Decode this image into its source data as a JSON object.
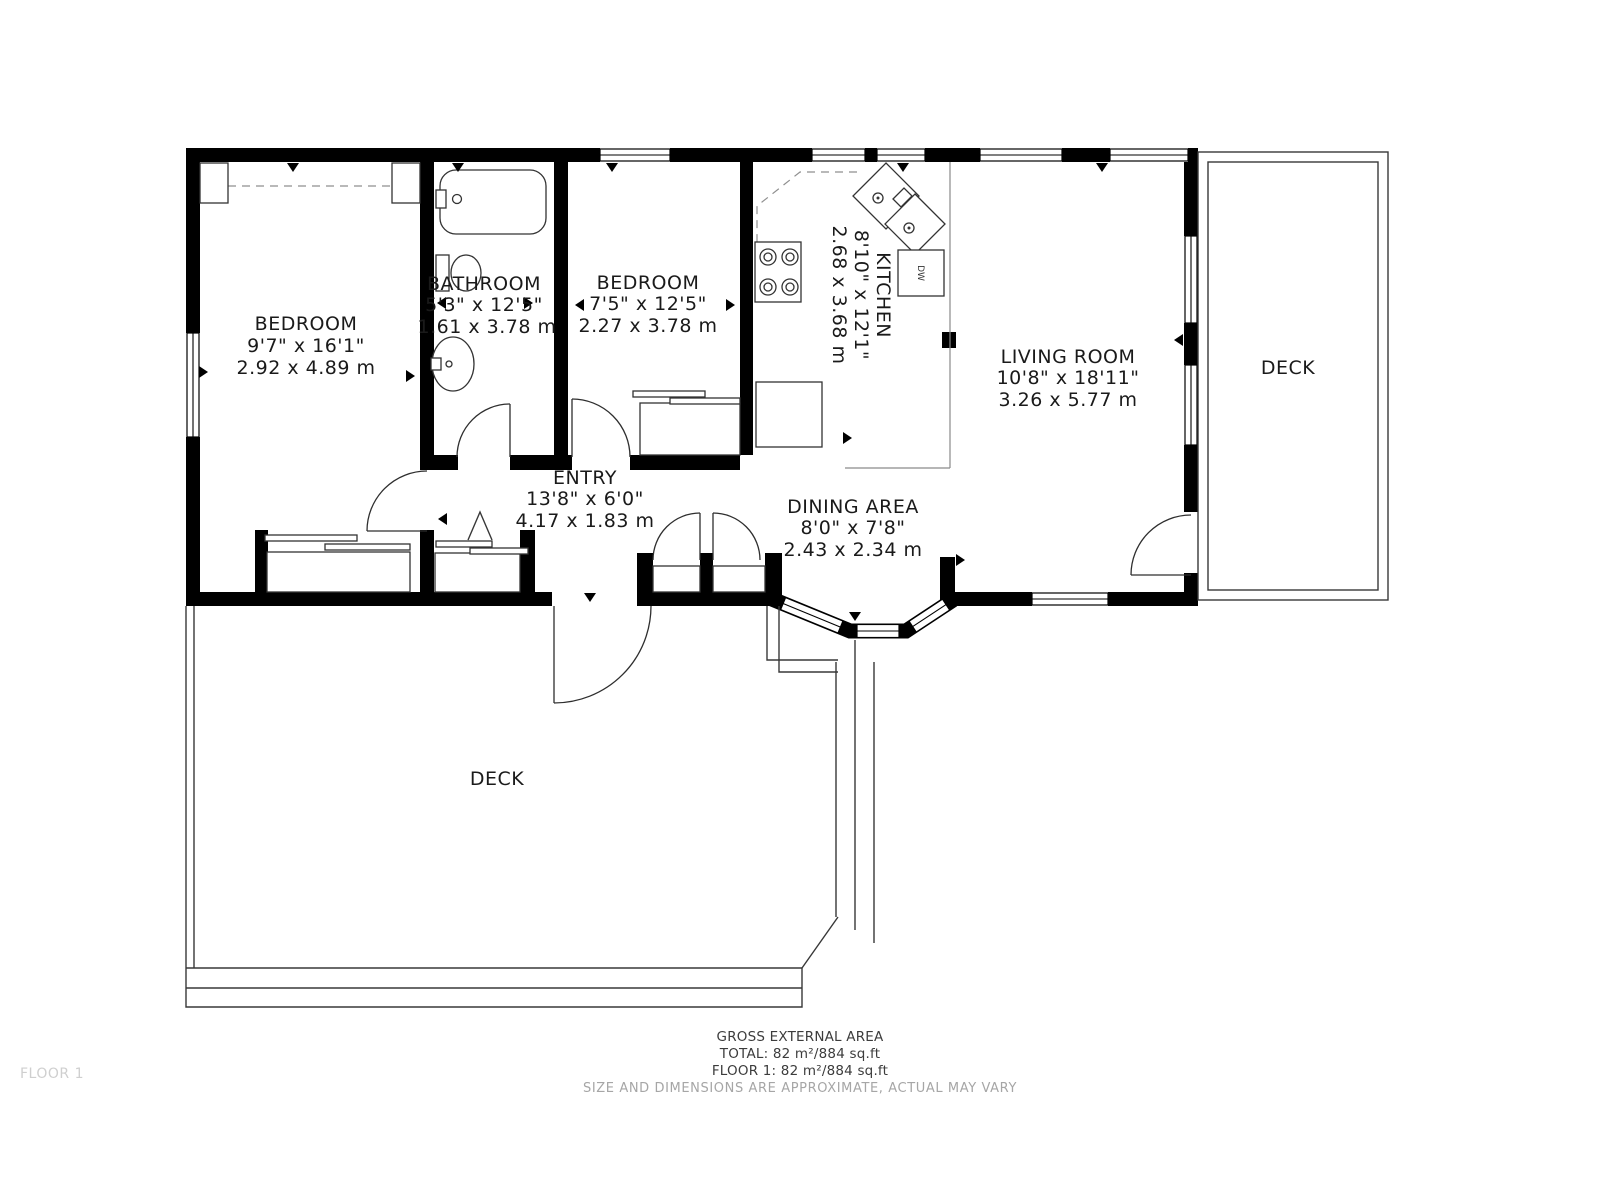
{
  "plan": {
    "rooms": {
      "bedroom1": {
        "name": "BEDROOM",
        "size_imperial": "9'7\" x 16'1\"",
        "size_metric": "2.92 x 4.89 m"
      },
      "bathroom": {
        "name": "BATHROOM",
        "size_imperial": "5'3\" x 12'5\"",
        "size_metric": "1.61 x 3.78 m"
      },
      "bedroom2": {
        "name": "BEDROOM",
        "size_imperial": "7'5\" x 12'5\"",
        "size_metric": "2.27 x 3.78 m"
      },
      "kitchen": {
        "name": "KITCHEN",
        "size_imperial": "8'10\" x 12'1\"",
        "size_metric": "2.68 x 3.68 m"
      },
      "living_room": {
        "name": "LIVING ROOM",
        "size_imperial": "10'8\" x 18'11\"",
        "size_metric": "3.26 x 5.77 m"
      },
      "entry": {
        "name": "ENTRY",
        "size_imperial": "13'8\" x 6'0\"",
        "size_metric": "4.17 x 1.83 m"
      },
      "dining_area": {
        "name": "DINING AREA",
        "size_imperial": "8'0\" x 7'8\"",
        "size_metric": "2.43 x 2.34 m"
      },
      "deck_right": {
        "name": "DECK"
      },
      "deck_bottom": {
        "name": "DECK"
      }
    },
    "fixtures": {
      "dishwasher_label": "DW"
    },
    "footer": {
      "title": "GROSS EXTERNAL AREA",
      "total": "TOTAL: 82 m²/884 sq.ft",
      "floor": "FLOOR 1: 82 m²/884 sq.ft",
      "disclaimer": "SIZE AND DIMENSIONS ARE APPROXIMATE, ACTUAL MAY VARY"
    },
    "floor_tag": "FLOOR 1",
    "colors": {
      "walls": "#000000",
      "label_text": "#1a1a1a",
      "footer_text": "#3c3c3c",
      "disclaimer_text": "#a6a6a6",
      "floor_tag_text": "#cfcfcf",
      "background": "#ffffff"
    }
  }
}
